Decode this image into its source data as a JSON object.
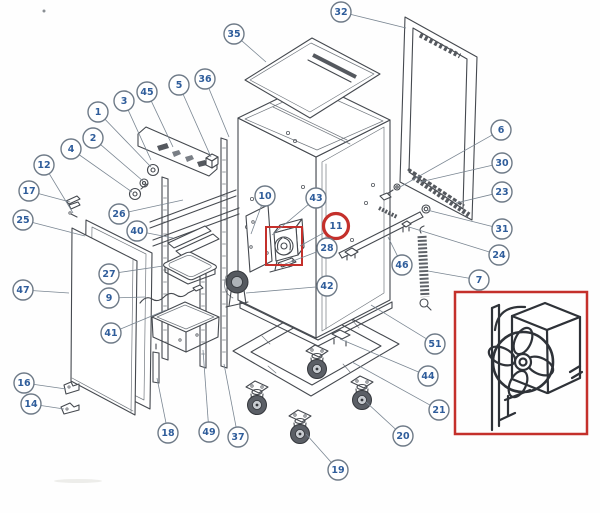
{
  "figure": {
    "kind": "exploded-parts-diagram",
    "subject": "heated holding cabinet exploded parts view",
    "background": "#fefefe",
    "artwork": {
      "line_color": "#45494f",
      "light_line_color": "#72787f",
      "dark_fill": "#55595f",
      "wheel_fill": "#5b5f66"
    },
    "balloon": {
      "stroke": "#6e7a87",
      "fill": "#ffffff",
      "text_color": "#2f5d9b",
      "radius": 10,
      "leader_color": "#7a8692"
    },
    "highlight": {
      "color": "#c4302b",
      "ring_radius": 12.5,
      "part_box": {
        "x": 266,
        "y": 227,
        "width": 36,
        "height": 38
      },
      "inset_box": {
        "x": 455,
        "y": 292,
        "width": 132,
        "height": 142
      }
    },
    "highlighted_callout": "11",
    "callouts": [
      {
        "label": "1",
        "cx": 98,
        "cy": 112,
        "tx": 151,
        "ty": 167
      },
      {
        "label": "2",
        "cx": 93,
        "cy": 138,
        "tx": 143,
        "ty": 181
      },
      {
        "label": "3",
        "cx": 124,
        "cy": 101,
        "tx": 151,
        "ty": 160
      },
      {
        "label": "4",
        "cx": 71,
        "cy": 149,
        "tx": 132,
        "ty": 192
      },
      {
        "label": "5",
        "cx": 179,
        "cy": 85,
        "tx": 211,
        "ty": 157
      },
      {
        "label": "6",
        "cx": 501,
        "cy": 130,
        "tx": 400,
        "ty": 187
      },
      {
        "label": "7",
        "cx": 479,
        "cy": 280,
        "tx": 428,
        "ty": 271
      },
      {
        "label": "9",
        "cx": 109,
        "cy": 298,
        "tx": 145,
        "ty": 297
      },
      {
        "label": "10",
        "cx": 265,
        "cy": 196,
        "tx": 251,
        "ty": 234
      },
      {
        "label": "11",
        "cx": 336,
        "cy": 226,
        "tx": 300,
        "ty": 246,
        "highlighted": true
      },
      {
        "label": "12",
        "cx": 44,
        "cy": 165,
        "tx": 73,
        "ty": 213
      },
      {
        "label": "14",
        "cx": 31,
        "cy": 404,
        "tx": 64,
        "ty": 409
      },
      {
        "label": "16",
        "cx": 24,
        "cy": 383,
        "tx": 66,
        "ty": 389
      },
      {
        "label": "17",
        "cx": 29,
        "cy": 191,
        "tx": 70,
        "ty": 202
      },
      {
        "label": "18",
        "cx": 168,
        "cy": 433,
        "tx": 157,
        "ty": 378
      },
      {
        "label": "19",
        "cx": 338,
        "cy": 470,
        "tx": 306,
        "ty": 434
      },
      {
        "label": "20",
        "cx": 403,
        "cy": 436,
        "tx": 366,
        "ty": 402
      },
      {
        "label": "21",
        "cx": 439,
        "cy": 410,
        "tx": 352,
        "ty": 362
      },
      {
        "label": "23",
        "cx": 502,
        "cy": 192,
        "tx": 456,
        "ty": 203
      },
      {
        "label": "24",
        "cx": 499,
        "cy": 255,
        "tx": 409,
        "ty": 227
      },
      {
        "label": "25",
        "cx": 23,
        "cy": 220,
        "tx": 85,
        "ty": 236
      },
      {
        "label": "26",
        "cx": 119,
        "cy": 214,
        "tx": 183,
        "ty": 200
      },
      {
        "label": "27",
        "cx": 109,
        "cy": 274,
        "tx": 163,
        "ty": 266
      },
      {
        "label": "28",
        "cx": 327,
        "cy": 248,
        "tx": 285,
        "ty": 264
      },
      {
        "label": "30",
        "cx": 502,
        "cy": 163,
        "tx": 420,
        "ty": 182
      },
      {
        "label": "31",
        "cx": 502,
        "cy": 229,
        "tx": 427,
        "ty": 210
      },
      {
        "label": "32",
        "cx": 341,
        "cy": 12,
        "tx": 406,
        "ty": 28
      },
      {
        "label": "35",
        "cx": 234,
        "cy": 34,
        "tx": 266,
        "ty": 62
      },
      {
        "label": "36",
        "cx": 205,
        "cy": 79,
        "tx": 229,
        "ty": 137
      },
      {
        "label": "37",
        "cx": 238,
        "cy": 437,
        "tx": 224,
        "ty": 364
      },
      {
        "label": "40",
        "cx": 137,
        "cy": 231,
        "tx": 173,
        "ty": 238
      },
      {
        "label": "41",
        "cx": 111,
        "cy": 333,
        "tx": 166,
        "ty": 310
      },
      {
        "label": "42",
        "cx": 327,
        "cy": 286,
        "tx": 246,
        "ty": 293
      },
      {
        "label": "43",
        "cx": 316,
        "cy": 198,
        "tx": 272,
        "ty": 235
      },
      {
        "label": "44",
        "cx": 428,
        "cy": 376,
        "tx": 340,
        "ty": 339
      },
      {
        "label": "45",
        "cx": 147,
        "cy": 92,
        "tx": 173,
        "ty": 147
      },
      {
        "label": "46",
        "cx": 402,
        "cy": 265,
        "tx": 388,
        "ty": 237
      },
      {
        "label": "47",
        "cx": 23,
        "cy": 290,
        "tx": 69,
        "ty": 293
      },
      {
        "label": "49",
        "cx": 209,
        "cy": 432,
        "tx": 203,
        "ty": 350
      },
      {
        "label": "51",
        "cx": 435,
        "cy": 344,
        "tx": 371,
        "ty": 305
      }
    ]
  }
}
